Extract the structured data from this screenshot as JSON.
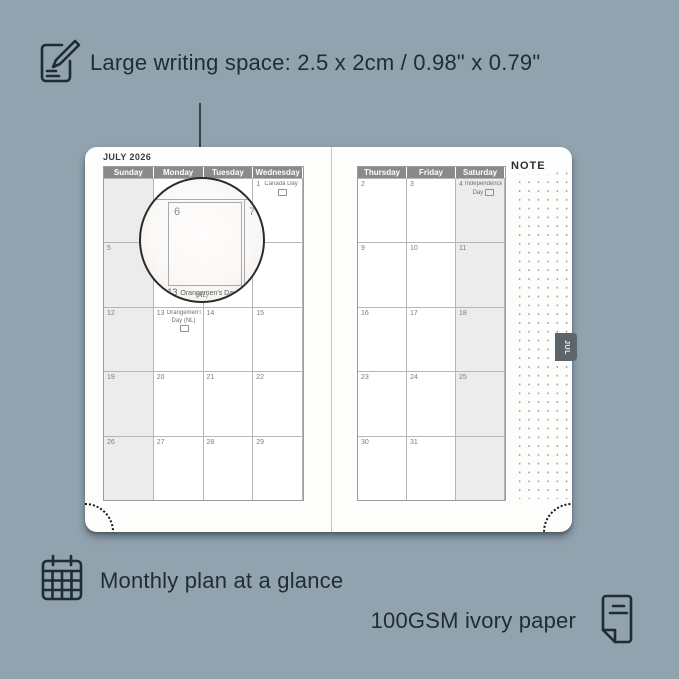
{
  "annotations": {
    "top": "Large writing space: 2.5 x 2cm / 0.98\" x 0.79\"",
    "bottom_left": "Monthly plan at a glance",
    "bottom_right": "100GSM ivory paper"
  },
  "icons": [
    "notepad-pencil-icon",
    "calendar-grid-icon",
    "paper-sheet-icon"
  ],
  "planner": {
    "month_title": "JULY 2026",
    "tab_label": "JUL",
    "note_label": "NOTE",
    "left_day_headers": [
      "Sunday",
      "Monday",
      "Tuesday",
      "Wednesday"
    ],
    "right_day_headers": [
      "Thursday",
      "Friday",
      "Saturday"
    ],
    "left_shaded_col": 0,
    "right_shaded_col": 2,
    "left_weeks": [
      [
        {},
        {},
        {},
        {
          "n": "1",
          "holiday": "Canada Day",
          "flag": true
        }
      ],
      [
        {
          "n": "5"
        },
        {
          "n": "6"
        },
        {
          "n": "7"
        },
        {
          "n": "8"
        }
      ],
      [
        {
          "n": "12"
        },
        {
          "n": "13",
          "holiday": "Orangemen's Day (NL)",
          "flag": true
        },
        {
          "n": "14"
        },
        {
          "n": "15"
        }
      ],
      [
        {
          "n": "19"
        },
        {
          "n": "20"
        },
        {
          "n": "21"
        },
        {
          "n": "22"
        }
      ],
      [
        {
          "n": "26"
        },
        {
          "n": "27"
        },
        {
          "n": "28"
        },
        {
          "n": "29"
        }
      ]
    ],
    "right_weeks": [
      [
        {
          "n": "2"
        },
        {
          "n": "3"
        },
        {
          "n": "4",
          "holiday": "Independence Day",
          "flag": true
        }
      ],
      [
        {
          "n": "9"
        },
        {
          "n": "10"
        },
        {
          "n": "11"
        }
      ],
      [
        {
          "n": "16"
        },
        {
          "n": "17"
        },
        {
          "n": "18"
        }
      ],
      [
        {
          "n": "23"
        },
        {
          "n": "24"
        },
        {
          "n": "25"
        }
      ],
      [
        {
          "n": "30"
        },
        {
          "n": "31"
        },
        {}
      ]
    ],
    "loupe": {
      "left_day": "6",
      "right_day": "7",
      "caption_num": "13",
      "caption_text": "Orangemen's Day",
      "caption_sub": "(NL)"
    }
  },
  "colors": {
    "background": "#91a3ae",
    "ink": "#222d33",
    "page": "#fdfdfc",
    "day_header_bg": "#8a8a8a",
    "shaded_column": "#ececec",
    "tab_bg": "#5d656b"
  }
}
